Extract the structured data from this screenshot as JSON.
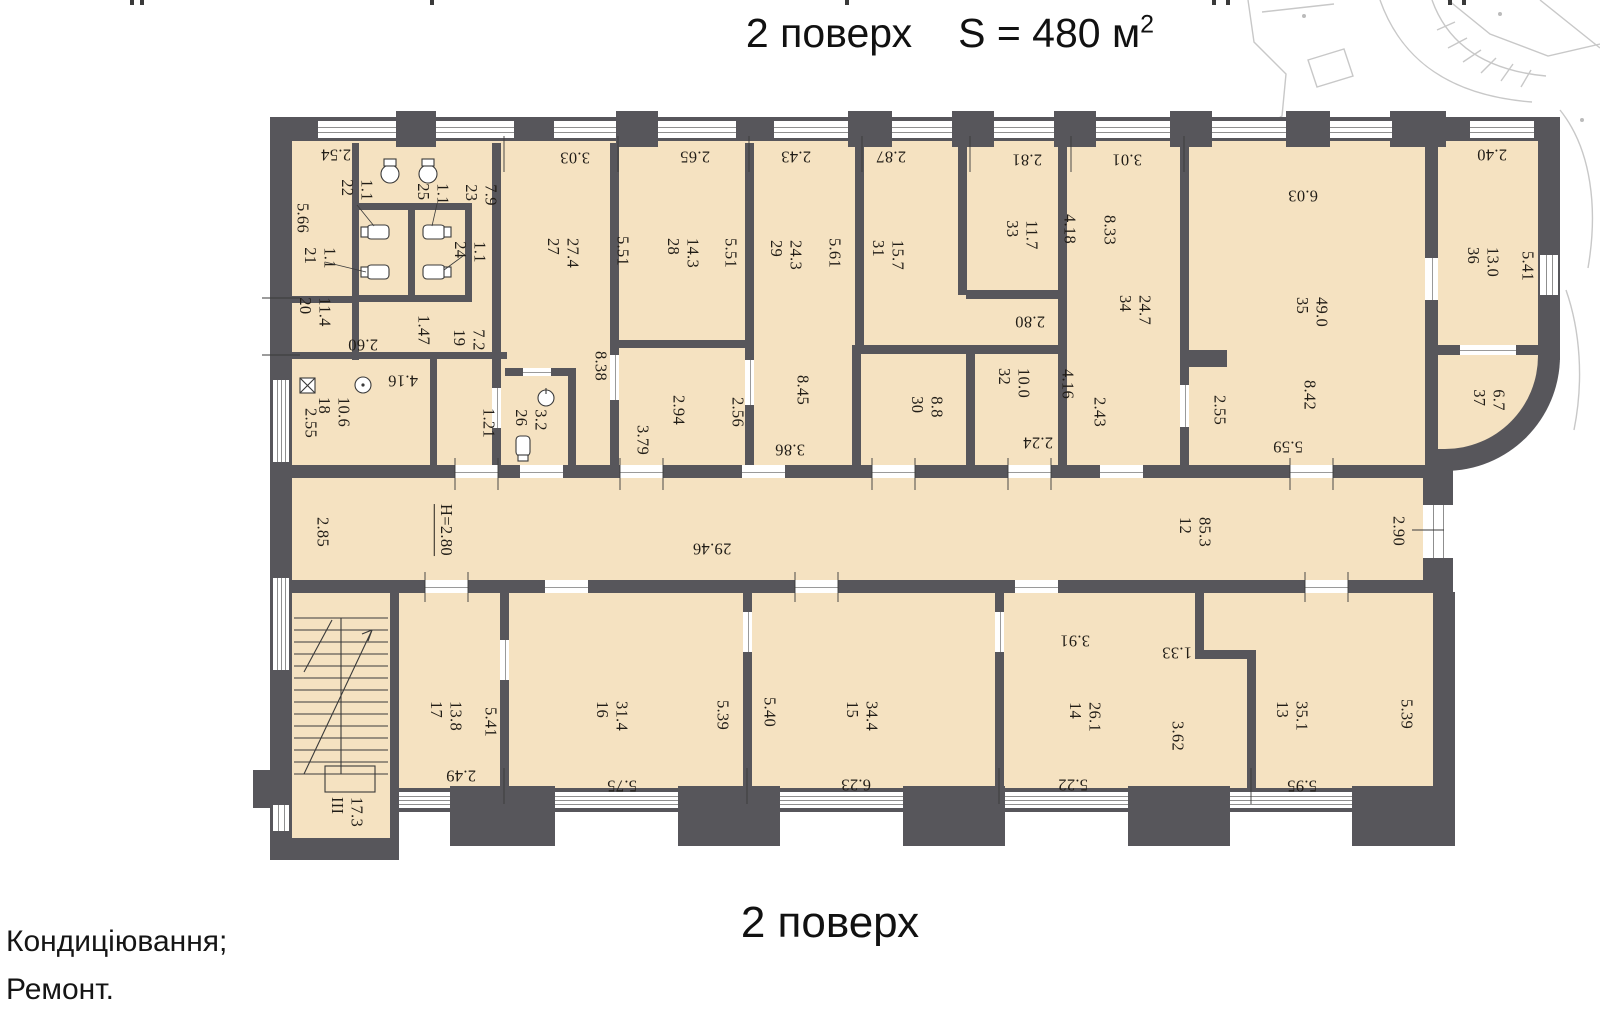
{
  "title": {
    "floor_label": "2 поверх",
    "area_value": "S = 480 м",
    "area_sup": "2"
  },
  "footer": {
    "note_line1": "Кондиціювання;",
    "note_line2": "Ремонт.",
    "floor_label": "2 поверх"
  },
  "colors": {
    "wall": "#57565b",
    "room_fill": "#f5e2c1",
    "window_line": "#8f8f8f",
    "sketch_line": "#c8c8c8",
    "text": "#211d17"
  },
  "plan": {
    "height_note": "H=2.80",
    "total_area_m2": "480",
    "labels": [
      {
        "name": "room-20",
        "text": "20\n11.4",
        "x": 315,
        "y": 312,
        "k": "v"
      },
      {
        "name": "room-21",
        "text": "21\n1.1",
        "x": 320,
        "y": 258,
        "k": "v"
      },
      {
        "name": "room-22",
        "text": "22\n1.1",
        "x": 357,
        "y": 190,
        "k": "v"
      },
      {
        "name": "room-23",
        "text": "23\n7.9",
        "x": 481,
        "y": 195,
        "k": "v"
      },
      {
        "name": "room-24",
        "text": "24\n1.1",
        "x": 470,
        "y": 252,
        "k": "v"
      },
      {
        "name": "room-25",
        "text": "25\n1.1",
        "x": 433,
        "y": 194,
        "k": "v"
      },
      {
        "name": "room-19",
        "text": "19\n7.2",
        "x": 469,
        "y": 340,
        "k": "v"
      },
      {
        "name": "room-18",
        "text": "18\n10.6",
        "x": 334,
        "y": 412,
        "k": "v"
      },
      {
        "name": "room-26",
        "text": "26\n3.2",
        "x": 531,
        "y": 420,
        "k": "v"
      },
      {
        "name": "room-27",
        "text": "27\n27.4",
        "x": 563,
        "y": 253,
        "k": "v"
      },
      {
        "name": "room-28",
        "text": "28\n14.3",
        "x": 683,
        "y": 253,
        "k": "v"
      },
      {
        "name": "room-29",
        "text": "29\n24.3",
        "x": 786,
        "y": 255,
        "k": "v"
      },
      {
        "name": "room-30",
        "text": "30\n8.8",
        "x": 927,
        "y": 407,
        "k": "v"
      },
      {
        "name": "room-31",
        "text": "31\n15.7",
        "x": 888,
        "y": 255,
        "k": "v"
      },
      {
        "name": "room-32",
        "text": "32\n10.0",
        "x": 1014,
        "y": 383,
        "k": "v"
      },
      {
        "name": "room-33",
        "text": "33\n11.7",
        "x": 1022,
        "y": 235,
        "k": "v"
      },
      {
        "name": "room-34",
        "text": "34\n24.7",
        "x": 1135,
        "y": 310,
        "k": "v"
      },
      {
        "name": "room-35",
        "text": "35\n49.0",
        "x": 1312,
        "y": 312,
        "k": "v"
      },
      {
        "name": "room-36",
        "text": "36\n13.0",
        "x": 1483,
        "y": 262,
        "k": "v"
      },
      {
        "name": "room-37",
        "text": "37\n6.7",
        "x": 1489,
        "y": 400,
        "k": "v"
      },
      {
        "name": "corridor-12",
        "text": "12\n85.3",
        "x": 1195,
        "y": 532,
        "k": "v"
      },
      {
        "name": "stairwell-iii",
        "text": "III\n17.3",
        "x": 347,
        "y": 812,
        "k": "v"
      },
      {
        "name": "room-17",
        "text": "17\n13.8",
        "x": 446,
        "y": 716,
        "k": "v"
      },
      {
        "name": "room-16",
        "text": "16\n31.4",
        "x": 612,
        "y": 716,
        "k": "v"
      },
      {
        "name": "room-15",
        "text": "15\n34.4",
        "x": 862,
        "y": 716,
        "k": "v"
      },
      {
        "name": "room-14",
        "text": "14\n26.1",
        "x": 1085,
        "y": 717,
        "k": "v"
      },
      {
        "name": "room-13",
        "text": "13\n35.1",
        "x": 1292,
        "y": 716,
        "k": "v"
      },
      {
        "name": "dim-5-66",
        "text": "5.66",
        "x": 303,
        "y": 218,
        "k": "v"
      },
      {
        "name": "dim-2-55-a",
        "text": "2.55",
        "x": 311,
        "y": 423,
        "k": "v"
      },
      {
        "name": "dim-1-47",
        "text": "1.47",
        "x": 424,
        "y": 330,
        "k": "v"
      },
      {
        "name": "dim-1-21",
        "text": "1.21",
        "x": 489,
        "y": 423,
        "k": "v"
      },
      {
        "name": "dim-5-51-a",
        "text": "5.51",
        "x": 623,
        "y": 251,
        "k": "v"
      },
      {
        "name": "dim-8-38",
        "text": "8.38",
        "x": 601,
        "y": 366,
        "k": "v"
      },
      {
        "name": "dim-3-79",
        "text": "3.79",
        "x": 643,
        "y": 440,
        "k": "v"
      },
      {
        "name": "dim-2-94",
        "text": "2.94",
        "x": 679,
        "y": 410,
        "k": "v"
      },
      {
        "name": "dim-2-56",
        "text": "2.56",
        "x": 738,
        "y": 412,
        "k": "v"
      },
      {
        "name": "dim-5-51-b",
        "text": "5.51",
        "x": 731,
        "y": 253,
        "k": "v"
      },
      {
        "name": "dim-5-61",
        "text": "5.61",
        "x": 835,
        "y": 253,
        "k": "v"
      },
      {
        "name": "dim-8-45",
        "text": "8.45",
        "x": 803,
        "y": 390,
        "k": "v"
      },
      {
        "name": "dim-3-86",
        "text": "3.86",
        "x": 790,
        "y": 450,
        "k": "r"
      },
      {
        "name": "dim-4-16-b",
        "text": "4.16",
        "x": 1068,
        "y": 384,
        "k": "v"
      },
      {
        "name": "dim-2-43-b",
        "text": "2.43",
        "x": 1100,
        "y": 412,
        "k": "v"
      },
      {
        "name": "dim-4-18",
        "text": "4.18",
        "x": 1070,
        "y": 229,
        "k": "v"
      },
      {
        "name": "dim-8-33",
        "text": "8.33",
        "x": 1110,
        "y": 230,
        "k": "v"
      },
      {
        "name": "dim-2-55-b",
        "text": "2.55",
        "x": 1220,
        "y": 410,
        "k": "v"
      },
      {
        "name": "dim-8-42",
        "text": "8.42",
        "x": 1310,
        "y": 395,
        "k": "v"
      },
      {
        "name": "dim-5-41-w",
        "text": "5.41",
        "x": 1528,
        "y": 266,
        "k": "v"
      },
      {
        "name": "dim-2-85",
        "text": "2.85",
        "x": 323,
        "y": 532,
        "k": "v"
      },
      {
        "name": "dim-2-90",
        "text": "2.90",
        "x": 1399,
        "y": 531,
        "k": "v"
      },
      {
        "name": "dim-5-41-a",
        "text": "5.41",
        "x": 491,
        "y": 722,
        "k": "v"
      },
      {
        "name": "dim-5-39-a",
        "text": "5.39",
        "x": 723,
        "y": 715,
        "k": "v"
      },
      {
        "name": "dim-5-40",
        "text": "5.40",
        "x": 770,
        "y": 712,
        "k": "v"
      },
      {
        "name": "dim-3-62",
        "text": "3.62",
        "x": 1178,
        "y": 736,
        "k": "v"
      },
      {
        "name": "dim-5-39-b",
        "text": "5.39",
        "x": 1407,
        "y": 714,
        "k": "v"
      },
      {
        "name": "dim-2-54",
        "text": "2.54",
        "x": 336,
        "y": 155,
        "k": "r"
      },
      {
        "name": "dim-2-60",
        "text": "2.60",
        "x": 363,
        "y": 345,
        "k": "r"
      },
      {
        "name": "dim-4-16-a",
        "text": "4.16",
        "x": 403,
        "y": 381,
        "k": "r"
      },
      {
        "name": "dim-3-03",
        "text": "3.03",
        "x": 575,
        "y": 158,
        "k": "r"
      },
      {
        "name": "dim-2-65",
        "text": "2.65",
        "x": 695,
        "y": 157,
        "k": "r"
      },
      {
        "name": "dim-2-43-a",
        "text": "2.43",
        "x": 796,
        "y": 157,
        "k": "r"
      },
      {
        "name": "dim-2-87",
        "text": "2.87",
        "x": 891,
        "y": 157,
        "k": "r"
      },
      {
        "name": "dim-2-81",
        "text": "2.81",
        "x": 1027,
        "y": 160,
        "k": "r"
      },
      {
        "name": "dim-3-01",
        "text": "3.01",
        "x": 1127,
        "y": 160,
        "k": "r"
      },
      {
        "name": "dim-6-03",
        "text": "6.03",
        "x": 1303,
        "y": 196,
        "k": "r"
      },
      {
        "name": "dim-2-40",
        "text": "2.40",
        "x": 1492,
        "y": 155,
        "k": "r"
      },
      {
        "name": "dim-5-59",
        "text": "5.59",
        "x": 1288,
        "y": 447,
        "k": "r"
      },
      {
        "name": "dim-2-80",
        "text": "2.80",
        "x": 1030,
        "y": 322,
        "k": "r"
      },
      {
        "name": "dim-2-24",
        "text": "2.24",
        "x": 1038,
        "y": 443,
        "k": "r"
      },
      {
        "name": "dim-29-46",
        "text": "29.46",
        "x": 712,
        "y": 549,
        "k": "r"
      },
      {
        "name": "dim-2-49",
        "text": "2.49",
        "x": 461,
        "y": 776,
        "k": "r"
      },
      {
        "name": "dim-5-75",
        "text": "5.75",
        "x": 622,
        "y": 786,
        "k": "r"
      },
      {
        "name": "dim-6-23",
        "text": "6.23",
        "x": 856,
        "y": 785,
        "k": "r"
      },
      {
        "name": "dim-3-91",
        "text": "3.91",
        "x": 1075,
        "y": 641,
        "k": "r"
      },
      {
        "name": "dim-5-22",
        "text": "5.22",
        "x": 1073,
        "y": 785,
        "k": "r"
      },
      {
        "name": "dim-1-33",
        "text": "1.33",
        "x": 1177,
        "y": 653,
        "k": "r"
      },
      {
        "name": "dim-5-95",
        "text": "5.95",
        "x": 1302,
        "y": 786,
        "k": "r"
      },
      {
        "name": "dim-ceiling-height",
        "text": "H=2.80",
        "x": 445,
        "y": 530,
        "k": "u"
      }
    ]
  }
}
